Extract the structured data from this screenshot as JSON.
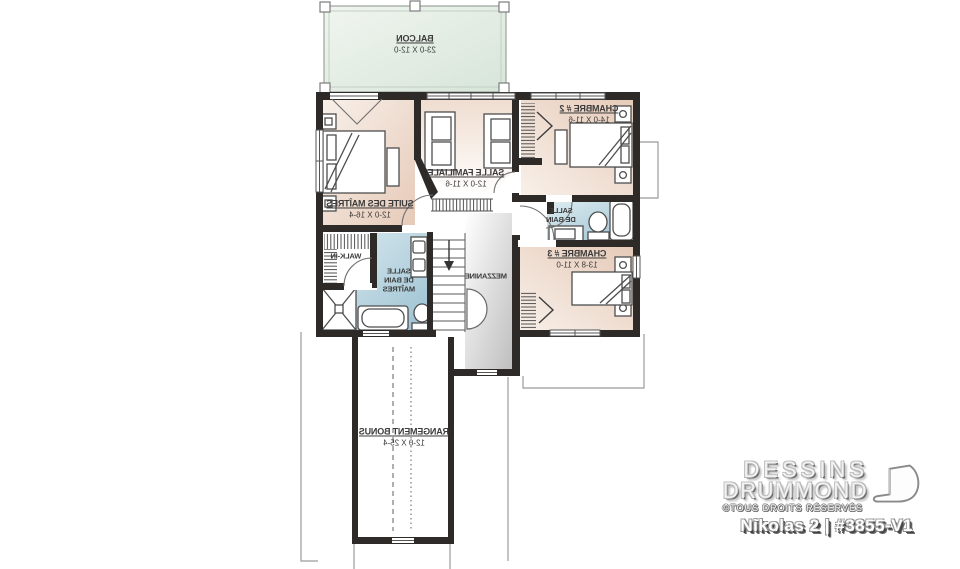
{
  "rooms": {
    "balcony": {
      "name": "BALCON",
      "dims": "23-0 X 12-0"
    },
    "master_suite": {
      "name": "SUITE DES MAÎTRES",
      "dims": "12-0 X 16-4"
    },
    "family_room": {
      "name": "SALLE FAMILIALE",
      "dims": "12-0 X 11-6"
    },
    "bedroom2": {
      "name": "CHAMBRE # 2",
      "dims": "14-0 X 11-6"
    },
    "bathroom": {
      "name": "SALLE\nDE BAIN",
      "dims": ""
    },
    "bedroom3": {
      "name": "CHAMBRE # 3",
      "dims": "13-8 X 11-0"
    },
    "walk_in": {
      "name": "WALK-IN",
      "dims": ""
    },
    "master_bath": {
      "name": "SALLE\nDE BAIN\nMAÎTRES",
      "dims": ""
    },
    "mezzanine": {
      "name": "MEZZANINE",
      "dims": ""
    },
    "bonus_storage": {
      "name": "RANGEMENT BONUS",
      "dims": "12-0 X 25-4"
    }
  },
  "footer": {
    "brand_line1": "DESSINS",
    "brand_line2": "DRUMMOND",
    "copyright": "©TOUS DROITS RÉSERVÉS",
    "plan_title": "Nikolas 2 | #3855-V1"
  },
  "colors": {
    "wall": "#2e2a27",
    "floor_beige": "#e8cfc0",
    "floor_bath": "#a3c6d6",
    "floor_balcony": "#dbe8dd",
    "floor_mezzanine": "#c9c9c9",
    "line": "#4d4d4d",
    "roofline": "#9b9b9b"
  }
}
